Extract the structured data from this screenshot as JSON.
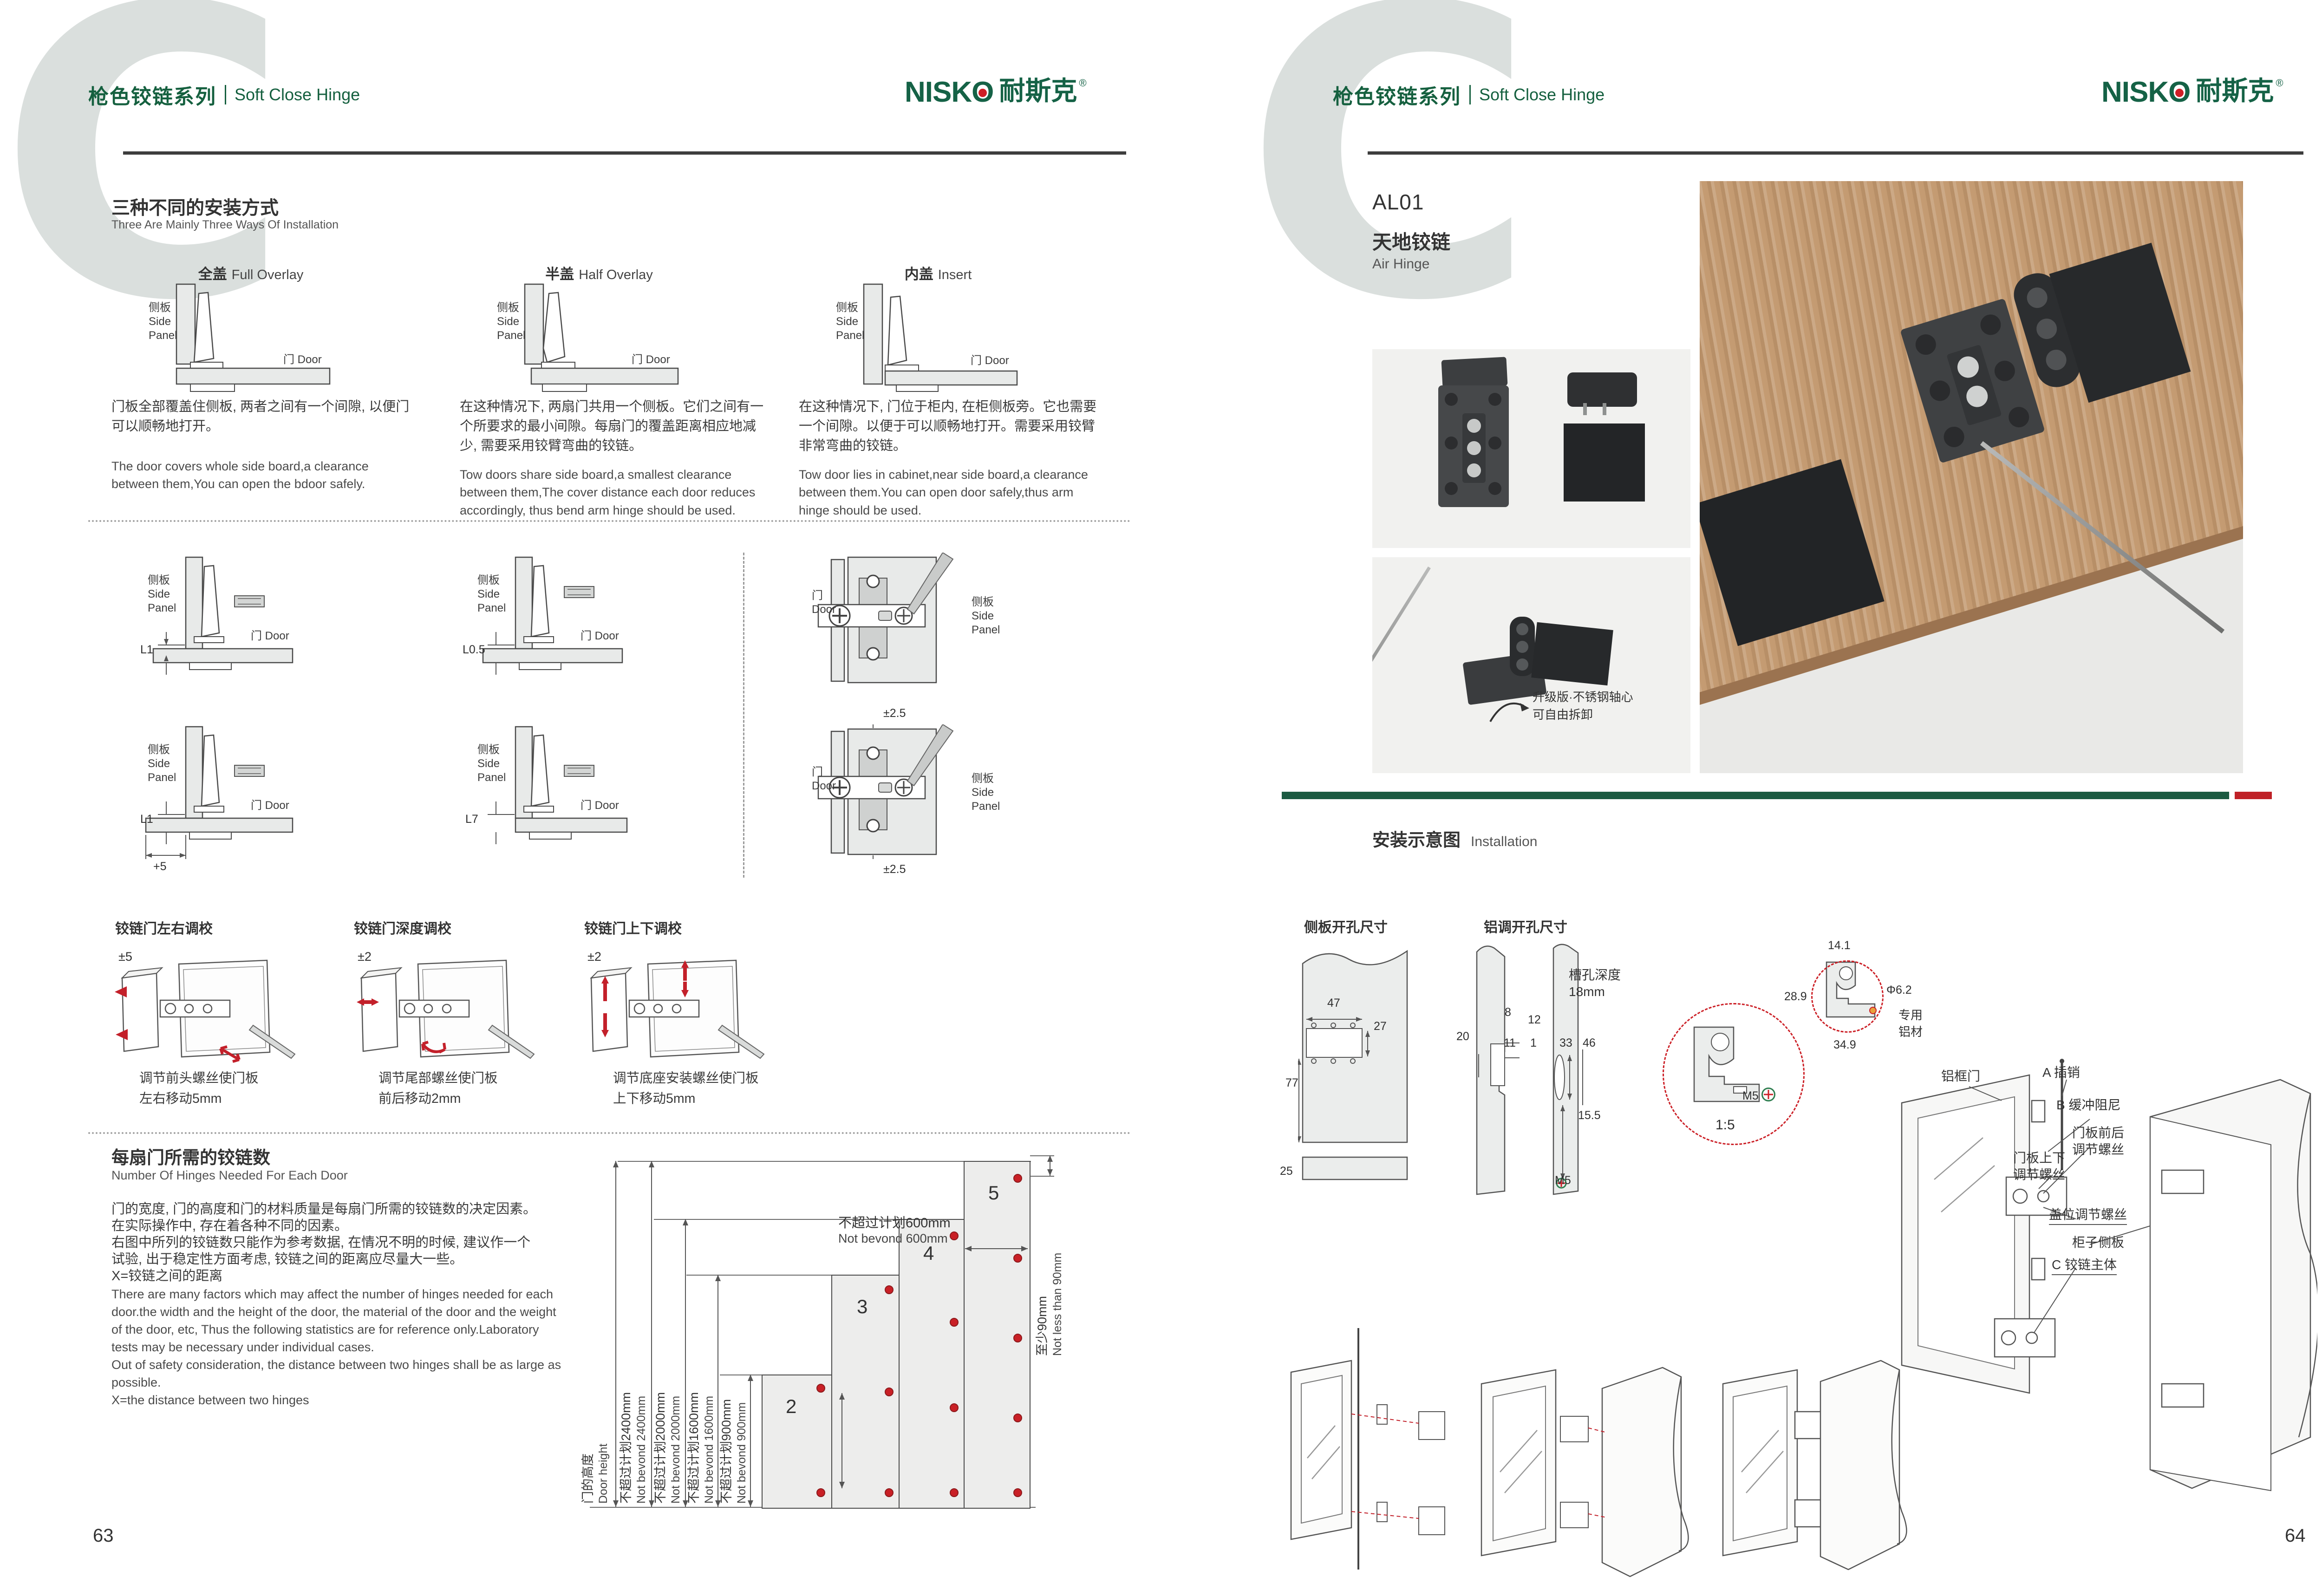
{
  "watermark": "C",
  "brand": {
    "series_cn": "枪色铰链系列",
    "series_en": "Soft Close Hinge",
    "logo_a": "NISK",
    "logo_o": "O",
    "logo_cn": "耐斯克",
    "logo_reg": "®"
  },
  "common": {
    "side_cn": "侧板",
    "side_en_1": "Side",
    "side_en_2": "Panel",
    "door_label": "门 Door",
    "door_cn": "门",
    "door_en": "Door"
  },
  "colors": {
    "brand_green": "#156246",
    "accent_red": "#c3202a",
    "rule_dark": "#3d3d3d",
    "diagram_fill": "#e8eae9",
    "photo_bg": "#f1f1ef",
    "wood": "#c49b72",
    "band_green": "#1b5a41",
    "band_red": "#bf2127"
  },
  "page_left": {
    "page_number": "63",
    "install_ways": {
      "title_cn": "三种不同的安装方式",
      "title_en": "Three Are Mainly Three Ways Of Installation",
      "methods": [
        {
          "name_cn": "全盖",
          "name_en": "Full Overlay",
          "desc_cn": "门板全部覆盖住侧板, 两者之间有一个间隙, 以便门可以顺畅地打开。",
          "desc_en": "The door covers whole side board,a clearance between them,You can open the bdoor safely."
        },
        {
          "name_cn": "半盖",
          "name_en": "Half Overlay",
          "desc_cn": "在这种情况下, 两扇门共用一个侧板。它们之间有一个所要求的最小间隙。每扇门的覆盖距离相应地减少, 需要采用铰臂弯曲的铰链。",
          "desc_en": "Tow doors share side board,a smallest clearance between them,The cover distance each door reduces accordingly, thus bend arm hinge should be used."
        },
        {
          "name_cn": "内盖",
          "name_en": "Insert",
          "desc_cn": "在这种情况下, 门位于柜内, 在柜侧板旁。它也需要一个间隙。以便于可以顺畅地打开。需要采用铰臂非常弯曲的铰链。",
          "desc_en": "Tow door lies in cabinet,near side board,a clearance between them.You can open door safely,thus arm hinge should be used."
        }
      ]
    },
    "clearances": {
      "d1": "L1",
      "d2": "L0.5",
      "d3": "L1",
      "d3_extra": "+5",
      "d4": "L7",
      "plate_adjust_top": "±2.5",
      "plate_adjust_bottom": "±2.5"
    },
    "adjustments": [
      {
        "title": "铰链门左右调校",
        "range": "±5",
        "cap1": "调节前头螺丝使门板",
        "cap2": "左右移动5mm"
      },
      {
        "title": "铰链门深度调校",
        "range": "±2",
        "cap1": "调节尾部螺丝使门板",
        "cap2": "前后移动2mm"
      },
      {
        "title": "铰链门上下调校",
        "range": "±2",
        "cap1": "调节底座安装螺丝使门板",
        "cap2": "上下移动5mm"
      }
    ],
    "hinge_count": {
      "title_cn": "每扇门所需的铰链数",
      "title_en": "Number Of Hinges Needed For Each Door",
      "cn_lines": [
        "门的宽度, 门的高度和门的材料质量是每扇门所需的铰链数的决定因素。",
        "在实际操作中, 存在着各种不同的因素。",
        "右图中所列的铰链数只能作为参考数据, 在情况不明的时候, 建议作一个",
        "试验, 出于稳定性方面考虑, 铰链之间的距离应尽量大一些。",
        "X=铰链之间的距离"
      ],
      "en_lines": [
        "There are many factors which may affect the number of hinges needed for each",
        "door.the width and the height of the door, the material of the door and the weight",
        "of the door, etc, Thus the following statistics are for reference only.Laboratory",
        "tests may be necessary under individual cases.",
        "Out of safety consideration, the distance between two hinges shall be as large as",
        "possible.",
        "X=the distance between two hinges"
      ],
      "chart": {
        "bars": [
          "2",
          "3",
          "4",
          "5"
        ],
        "door_height_cn": "门的高度",
        "door_height_en": "Door height",
        "lim_2400_cn": "不超过计划2400mm",
        "lim_2400_en": "Not bevond 2400mm",
        "lim_2000_cn": "不超过计划2000mm",
        "lim_2000_en": "Not bevond 2000mm",
        "lim_1600_cn": "不超过计划1600mm",
        "lim_1600_en": "Not bevond 1600mm",
        "lim_900_cn": "不超过计划900mm",
        "lim_900_en": "Not bevond 900mm",
        "width_cn": "不超过计划600mm",
        "width_en": "Not bevond 600mm",
        "min_cn": "至少90mm",
        "min_en": "Not less than 90mm"
      }
    }
  },
  "page_right": {
    "page_number": "64",
    "product": {
      "code": "AL01",
      "name_cn": "天地铰链",
      "name_en": "Air Hinge"
    },
    "photo_note": {
      "line1": "升级版·不锈钢轴心",
      "line2": "可自由拆卸"
    },
    "installation": {
      "title_cn": "安装示意图",
      "title_en": "Installation",
      "side_drill": {
        "title": "侧板开孔尺寸",
        "w": "47",
        "h": "27",
        "b": "77",
        "strip": "25"
      },
      "alu_drill": {
        "title": "铝调开孔尺寸",
        "d8": "8",
        "d20": "20",
        "d11": "11",
        "d12": "12",
        "d1": "1",
        "d33": "33",
        "d46": "46",
        "d155": "15.5",
        "slot1": "槽孔深度",
        "slot2": "18mm",
        "screw": "M5"
      },
      "profile": {
        "top": "14.1",
        "left": "28.9",
        "dia": "Φ6.2",
        "bottom": "34.9",
        "mat1": "专用",
        "mat2": "铝材",
        "scale": "1:5",
        "screw": "M5"
      },
      "exploded": {
        "frame_door": "铝框门",
        "pin": "A 插销",
        "damper": "B 缓冲阻尼",
        "fb1": "门板前后",
        "fb2": "调节螺丝",
        "ud1": "门板上下",
        "ud2": "调节螺丝",
        "cover": "盖位调节螺丝",
        "cabinet": "柜子侧板",
        "hinge_body": "C 铰链主体"
      }
    }
  },
  "chart_data": {
    "type": "bar",
    "title": "每扇门所需的铰链数 Number Of Hinges Needed For Each Door",
    "categories": [
      "门高不超过900mm",
      "门高不超过1600mm",
      "门高不超过2000mm",
      "门高不超过2400mm"
    ],
    "values": [
      2,
      3,
      4,
      5
    ],
    "xlabel": "hinges per door",
    "ylabel": "门的高度 Door height",
    "ylim": [
      0,
      2400
    ],
    "grid": false,
    "legend_position": "none",
    "annotations": [
      "不超过计划600mm Not bevond 600mm (max door width)",
      "至少90mm Not less than 90mm (min hinge end distance)",
      "X=铰链之间的距离 X=the distance between two hinges"
    ]
  }
}
